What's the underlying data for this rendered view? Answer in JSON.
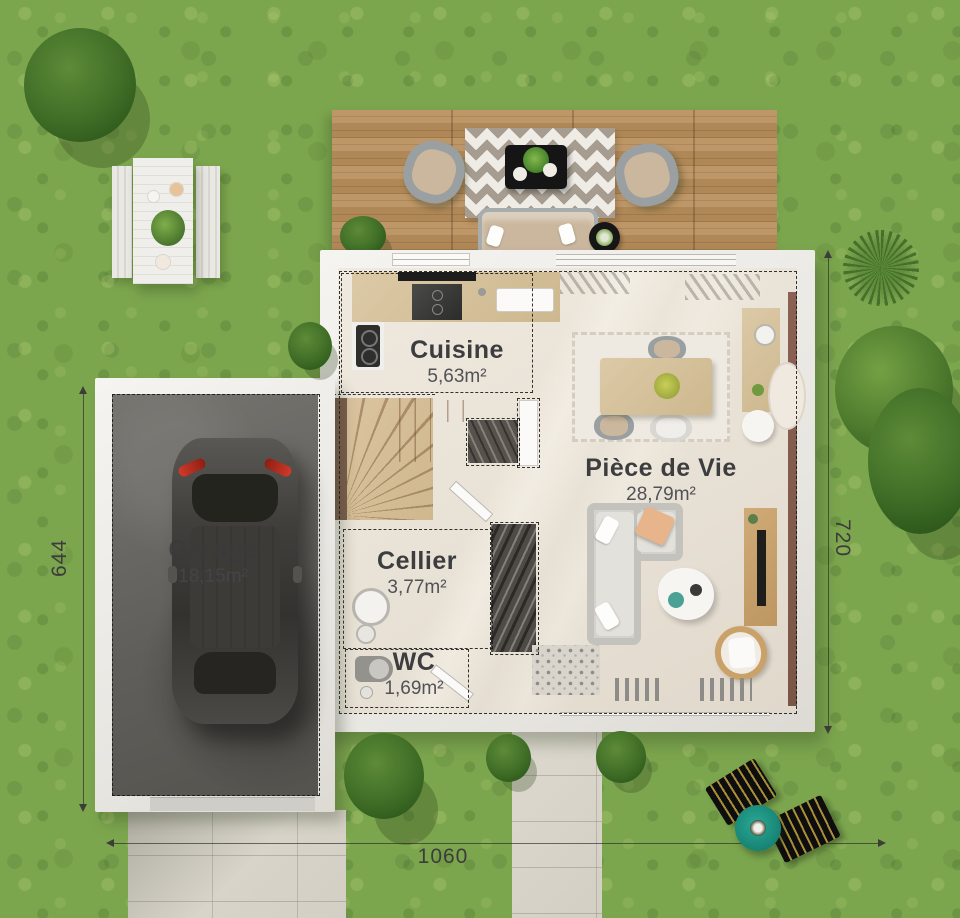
{
  "plan": {
    "rooms": [
      {
        "id": "cuisine",
        "name": "Cuisine",
        "area": "5,63m²"
      },
      {
        "id": "piece-de-vie",
        "name": "Pièce de Vie",
        "area": "28,79m²"
      },
      {
        "id": "cellier",
        "name": "Cellier",
        "area": "3,77m²"
      },
      {
        "id": "wc",
        "name": "WC",
        "area": "1,69m²"
      },
      {
        "id": "garage",
        "name": "Garage",
        "area": "18,15m²"
      }
    ],
    "dimensions": {
      "left": "644",
      "right": "720",
      "bottom": "1060"
    }
  },
  "colors": {
    "grass": "#7ca64e",
    "deck_wood": "#b48a58",
    "house_wall": "#f2f0ec",
    "interior_floor": "#e9e2d7",
    "garage_floor": "#6b6967",
    "stairs_wood": "#d6bf9c",
    "umbrella": "#1f9b8a",
    "car_body": "#44433f",
    "dimension_text": "#3c3c3c"
  }
}
